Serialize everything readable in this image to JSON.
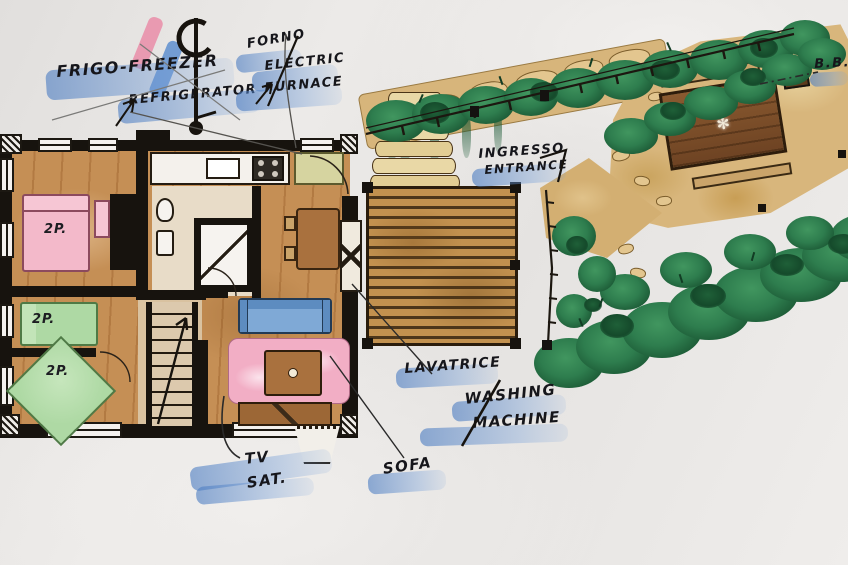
{
  "document": {
    "kind": "hand-drawn watercolor floor plan of a holiday home with deck, garden and pergola"
  },
  "labels": {
    "fridge_it": "FRIGO-FREEZER",
    "fridge_en": "REFRIGERATOR",
    "oven_it": "FORNO",
    "oven_en_1": "ELECTRIC",
    "oven_en_2": "FURNACE",
    "entrance_it": "INGRESSO",
    "entrance_en": "ENTRANCE",
    "bbq": "B.B.Q",
    "washer_it": "LAVATRICE",
    "washer_en_1": "WASHING",
    "washer_en_2": "MACHINE",
    "tv_1": "TV",
    "tv_2": "SAT.",
    "sofa": "SOFA"
  },
  "rooms": {
    "bedroom_double": "2P.",
    "bedroom_twin": "2P.",
    "bedroom_corner": "2P."
  },
  "icons": {
    "table_centerpiece": "✻"
  },
  "palette": {
    "paper": "#e9e7e5",
    "highlighter_blue": "#4d7dc2",
    "ink_black": "#17130e",
    "wood_floor": "#c58f55",
    "deck_wood": "#c2914f",
    "stone_tan": "#d7b57b",
    "hedge_green": "#2e7d4e",
    "bed_pink": "#f3b9ca",
    "bed_green": "#aed9a4",
    "rug_pink": "#f2aec5",
    "sofa_blue": "#7fa9d6",
    "table_brown": "#8a5a30",
    "compass_pink": "#e982a0"
  }
}
